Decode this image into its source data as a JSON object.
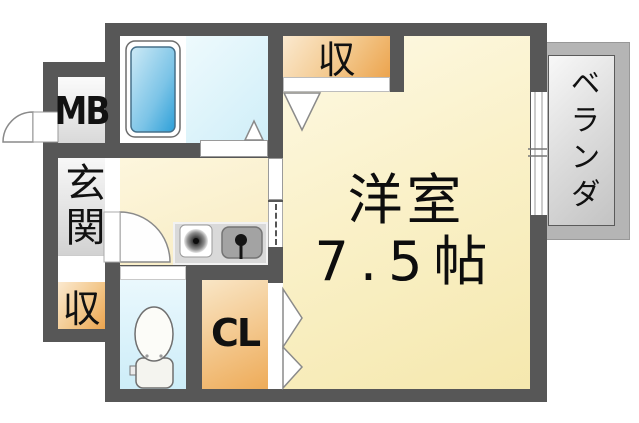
{
  "floorplan": {
    "rooms": {
      "main_room": {
        "name": "洋室",
        "size": "7.5帖"
      },
      "balcony": {
        "label": "ベランダ"
      },
      "entrance": {
        "label": "玄関"
      },
      "meter_box": {
        "label": "MB"
      },
      "storage_top": {
        "label": "収"
      },
      "storage_entry": {
        "label": "収"
      },
      "closet": {
        "label": "CL"
      }
    },
    "fixtures": {
      "bathtub": "bathtub",
      "toilet": "toilet",
      "stove": "stove-burner",
      "sink": "kitchen-sink",
      "entrance_door": "entrance-swing-door",
      "kitchen_door": "kitchen-swing-door",
      "folding_door": "folding-door",
      "window": "sliding-window"
    },
    "colors": {
      "wall": "#575757",
      "main_room_floor": "#f8eebc",
      "storage_orange": "#eda64f",
      "bath_blue": "#45aadd",
      "toilet_floor": "#d5f0f9",
      "veranda_gray": "#b5b5b5"
    }
  }
}
